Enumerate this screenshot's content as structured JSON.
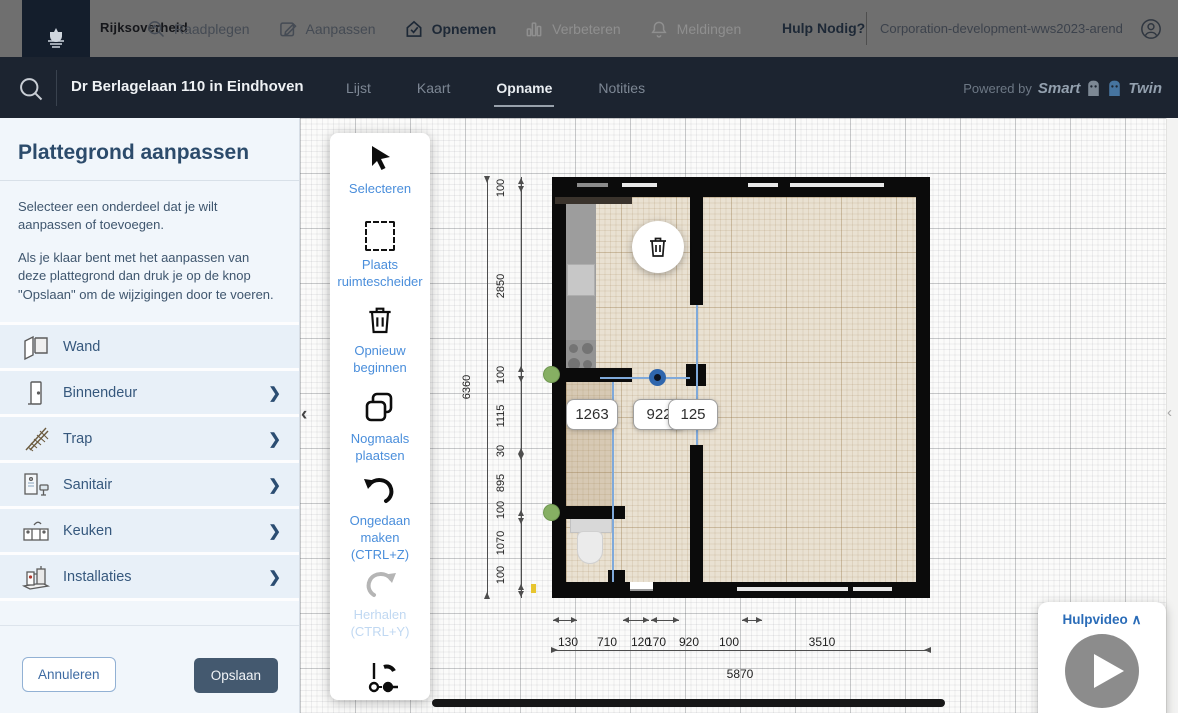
{
  "topbar": {
    "brand": "Rijksoverheid",
    "menu": [
      {
        "label": "Raadplegen"
      },
      {
        "label": "Aanpassen"
      },
      {
        "label": "Opnemen"
      },
      {
        "label": "Verbeteren"
      },
      {
        "label": "Meldingen"
      }
    ],
    "help": "Hulp Nodig?",
    "account": "Corporation-development-wws2023-arend"
  },
  "subheader": {
    "address": "Dr Berlagelaan 110 in Eindhoven",
    "tabs": [
      {
        "label": "Lijst"
      },
      {
        "label": "Kaart"
      },
      {
        "label": "Opname"
      },
      {
        "label": "Notities"
      }
    ],
    "powered_by": "Powered by",
    "brand_smart": "Smart",
    "brand_twin": "Twin"
  },
  "sidebar": {
    "title": "Plattegrond aanpassen",
    "intro1": "Selecteer een onderdeel dat je wilt aanpassen of toevoegen.",
    "intro2": "Als je klaar bent met het aanpassen van deze plattegrond dan druk je op de knop \"Opslaan\" om de wijzigingen door te voeren.",
    "items": [
      {
        "label": "Wand"
      },
      {
        "label": "Binnendeur"
      },
      {
        "label": "Trap"
      },
      {
        "label": "Sanitair"
      },
      {
        "label": "Keuken"
      },
      {
        "label": "Installaties"
      }
    ],
    "cancel_label": "Annuleren",
    "save_label": "Opslaan"
  },
  "toolbar": {
    "items": [
      {
        "label": "Selecteren"
      },
      {
        "label": "Plaats ruimtescheider"
      },
      {
        "label": "Opnieuw beginnen"
      },
      {
        "label": "Nogmaals plaatsen"
      },
      {
        "label": "Ongedaan maken (CTRL+Z)"
      },
      {
        "label": "Herhalen (CTRL+Y)"
      }
    ]
  },
  "plan": {
    "dims_left": [
      "100",
      "2850",
      "100",
      "1115",
      "30",
      "895",
      "100",
      "1070",
      "100"
    ],
    "dim_total_left": "6360",
    "dims_bottom": [
      "130",
      "710",
      "120",
      "170",
      "920",
      "100",
      "3510"
    ],
    "dim_total_bottom": "5870",
    "chips": [
      "1263",
      "922",
      "125"
    ]
  },
  "help_video": {
    "label": "Hulpvideo"
  },
  "icons": {
    "sidebar_chevron": "❯",
    "collapse_left": "‹",
    "collapse_right": "‹",
    "help_chevron": "∧"
  },
  "colors": {
    "topbar_gray": "#6f6f6f",
    "header_navy": "#1c2430",
    "accent_blue": "#4a8edb",
    "selection_blue": "#2f66ad",
    "save_button": "#44596f",
    "sidebar_row": "#e8f0f8",
    "wall_black": "#0b0b0b",
    "floor_beige": "#e9e1d2",
    "handle_green": "#86af63"
  }
}
